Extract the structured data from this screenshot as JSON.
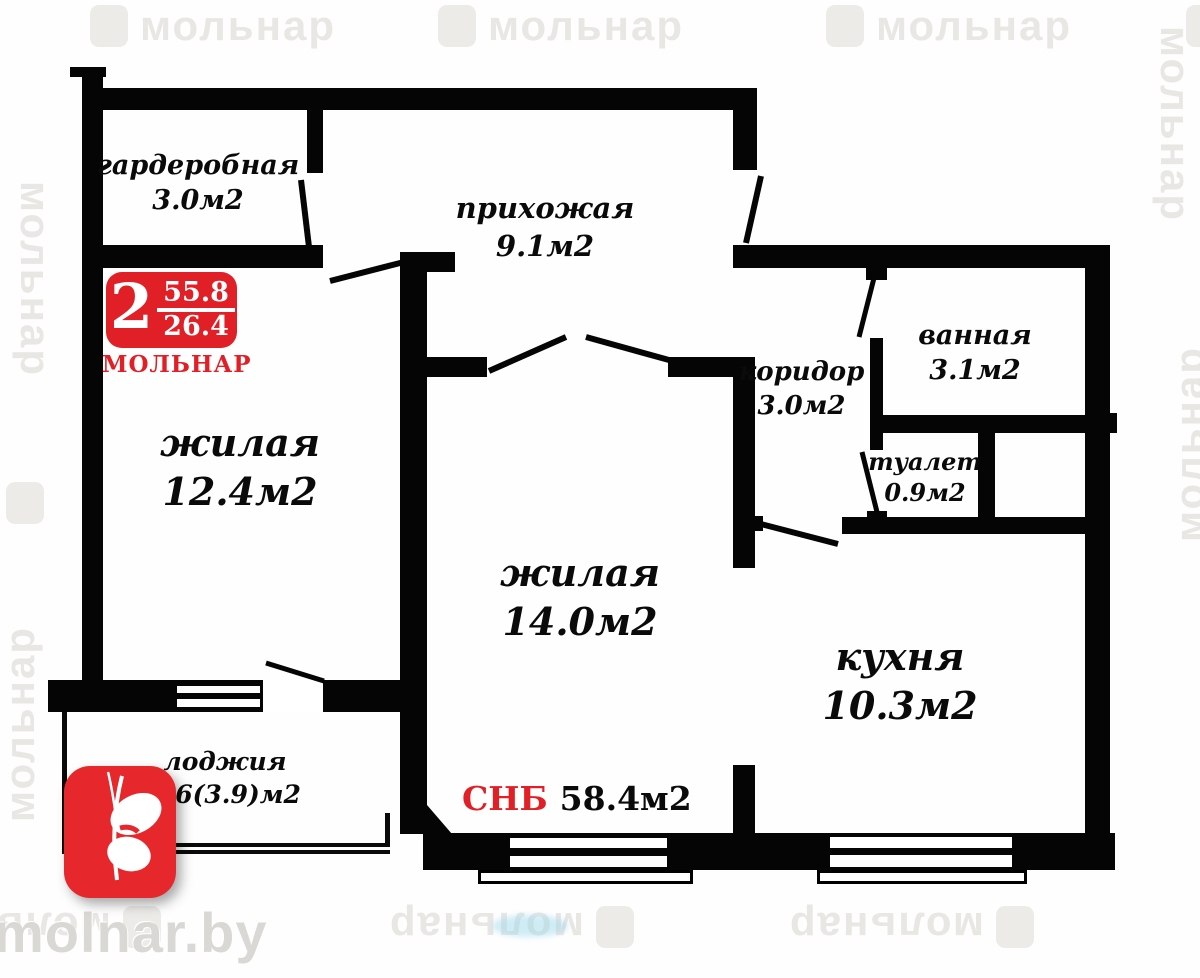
{
  "watermark": {
    "text": "мольнар"
  },
  "site": {
    "name": "molnar.by"
  },
  "badge": {
    "rooms_count": "2",
    "total_area": "55.8",
    "living_area": "26.4",
    "brand": "МОЛЬНАР"
  },
  "rooms": {
    "garderobnaya": {
      "name": "гардеробная",
      "area": "3.0м2"
    },
    "prihozhaya": {
      "name": "прихожая",
      "area": "9.1м2"
    },
    "vannaya": {
      "name": "ванная",
      "area": "3.1м2"
    },
    "koridor": {
      "name": "коридор",
      "area": "3.0м2"
    },
    "tualet": {
      "name": "туалет",
      "area": "0.9м2"
    },
    "zhilaya_left": {
      "name": "жилая",
      "area": "12.4м2"
    },
    "zhilaya_center": {
      "name": "жилая",
      "area": "14.0м2"
    },
    "kuhnya": {
      "name": "кухня",
      "area": "10.3м2"
    },
    "lodzhiya": {
      "name": "лоджия",
      "area": "2.6(3.9)м2"
    }
  },
  "total": {
    "label": "СНБ",
    "value": "58.4м2"
  },
  "colors": {
    "accent": "#e11f26",
    "wall": "#050505",
    "watermark": "#e9e7e4"
  }
}
